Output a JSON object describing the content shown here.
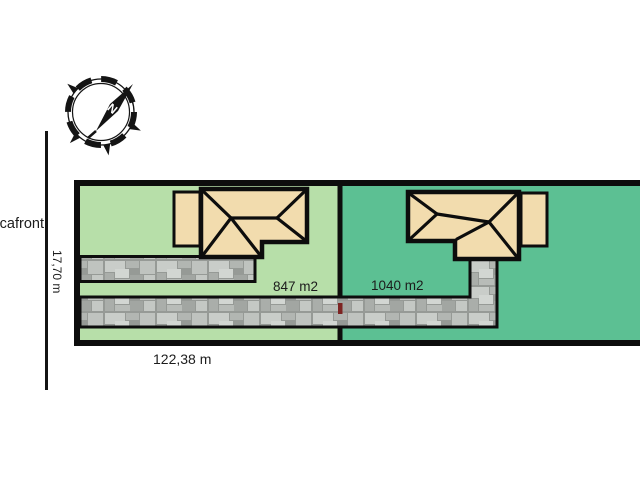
{
  "street": {
    "label": "tcafront"
  },
  "compass": {
    "north_label": "N"
  },
  "dimensions": {
    "frontage_label": "17,70 m",
    "width_label": "122,38 m"
  },
  "parcels": [
    {
      "area_label": "847 m2",
      "color": "#b7dfa9"
    },
    {
      "area_label": "1040 m2",
      "color": "#5cc093"
    }
  ],
  "colors": {
    "house_fill": "#f2dcae",
    "outline": "#0d0d0d",
    "stone_grout": "#969a96",
    "boundary_marker": "#7d2422"
  }
}
